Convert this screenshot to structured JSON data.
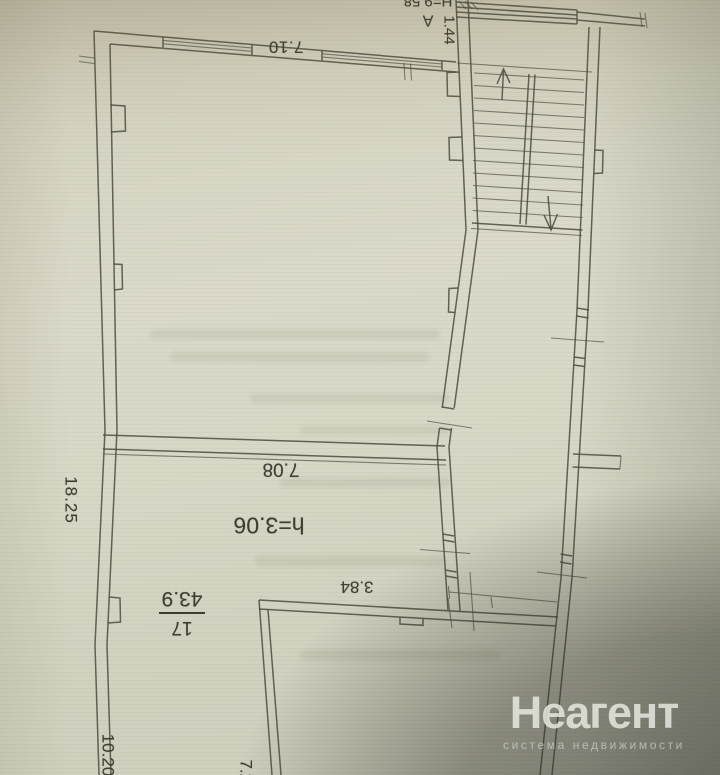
{
  "plan": {
    "labels": {
      "dim_7_10": "7.10",
      "section_letter": "А",
      "section_height": "Н=9.58",
      "dim_1_44": "1.44",
      "dim_7_08": "7.08",
      "ceiling_height": "h=3.06",
      "dim_3_84": "3.84",
      "room_number": "17",
      "room_area": "43.9",
      "dim_18_25": "18.25",
      "dim_10_20": "10.20",
      "dim_7_20": "7.20"
    },
    "colors": {
      "ink": "#4b4b40",
      "paper": "#d9d8c7",
      "shadow": "#84877a"
    }
  },
  "watermark": {
    "title": "Неагент",
    "subtitle": "система недвижимости"
  }
}
